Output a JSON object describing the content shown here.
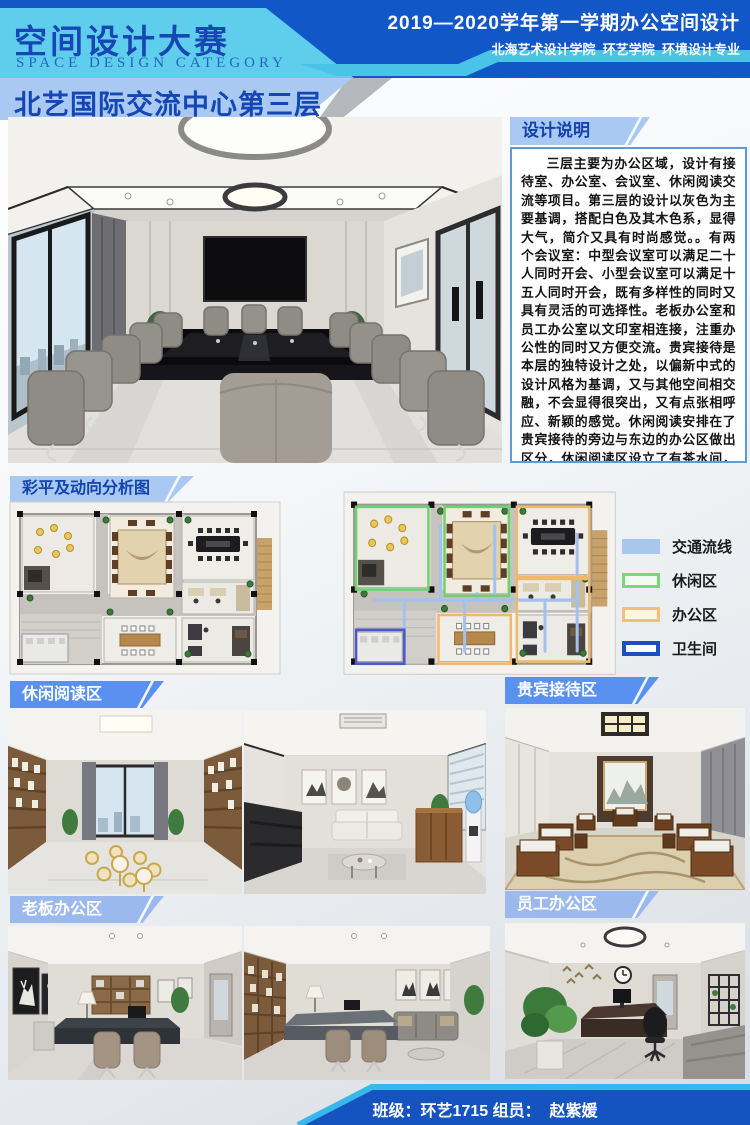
{
  "header": {
    "title": "空间设计大赛",
    "subtitle": "SPACE DESIGN CATEGORY",
    "term_line": "2019—2020学年第一学期办公空间设计",
    "dept_line": "北海艺术设计学院  环艺学院  环境设计专业",
    "banner_main": "北艺国际交流中心",
    "banner_floor": "第三层"
  },
  "design_notes": {
    "label": "设计说明",
    "body": "三层主要为办公区域，设计有接待室、办公室、会议室、休闲阅读交流等项目。第三层的设计以灰色为主要基调，搭配白色及其木色系，显得大气，简介又具有时尚感觉。。有两个会议室：中型会议室可以满足二十人同时开会、小型会议室可以满足十五人同时开会，既有多样性的同时又具有灵活的可选择性。老板办公室和员工办公室以文印室相连接，注重办公性的同时又方便交流。贵宾接待是本层的独特设计之处，以偏新中式的设计风格为基调，又与其他空间相交融，不会显得很突出，又有点张相呼应、新颖的感觉。休闲阅读安排在了贵宾接待的旁边与东边的办公区做出区分，休闲阅读区设立了有茶水间，可以满足大家的各种需求。"
  },
  "plan_section": {
    "label": "彩平及动向分析图",
    "legend": [
      {
        "label": "交通流线",
        "color": "#a9c6ec",
        "style": "fill"
      },
      {
        "label": "休闲区",
        "color": "#7bd67b",
        "style": "outline"
      },
      {
        "label": "办公区",
        "color": "#f2c176",
        "style": "outline"
      },
      {
        "label": "卫生间",
        "color": "#1a50c0",
        "style": "outline"
      }
    ]
  },
  "sections": {
    "leisure_reading": "休闲阅读区",
    "vip_reception": "贵宾接待区",
    "boss_office": "老板办公区",
    "staff_office": "员工办公区"
  },
  "footer": {
    "credit": "班级：环艺1715 组员：  赵紫媛"
  },
  "colors": {
    "header_blue": "#1157c8",
    "cyan_band": "#5fceec",
    "banner_light_blue": "#a9c8f2",
    "title_blue": "#1547b4",
    "tag_blue": "#5a91f0",
    "tag_periwinkle": "#9cb9ee",
    "footer_blue": "#1453c0"
  }
}
